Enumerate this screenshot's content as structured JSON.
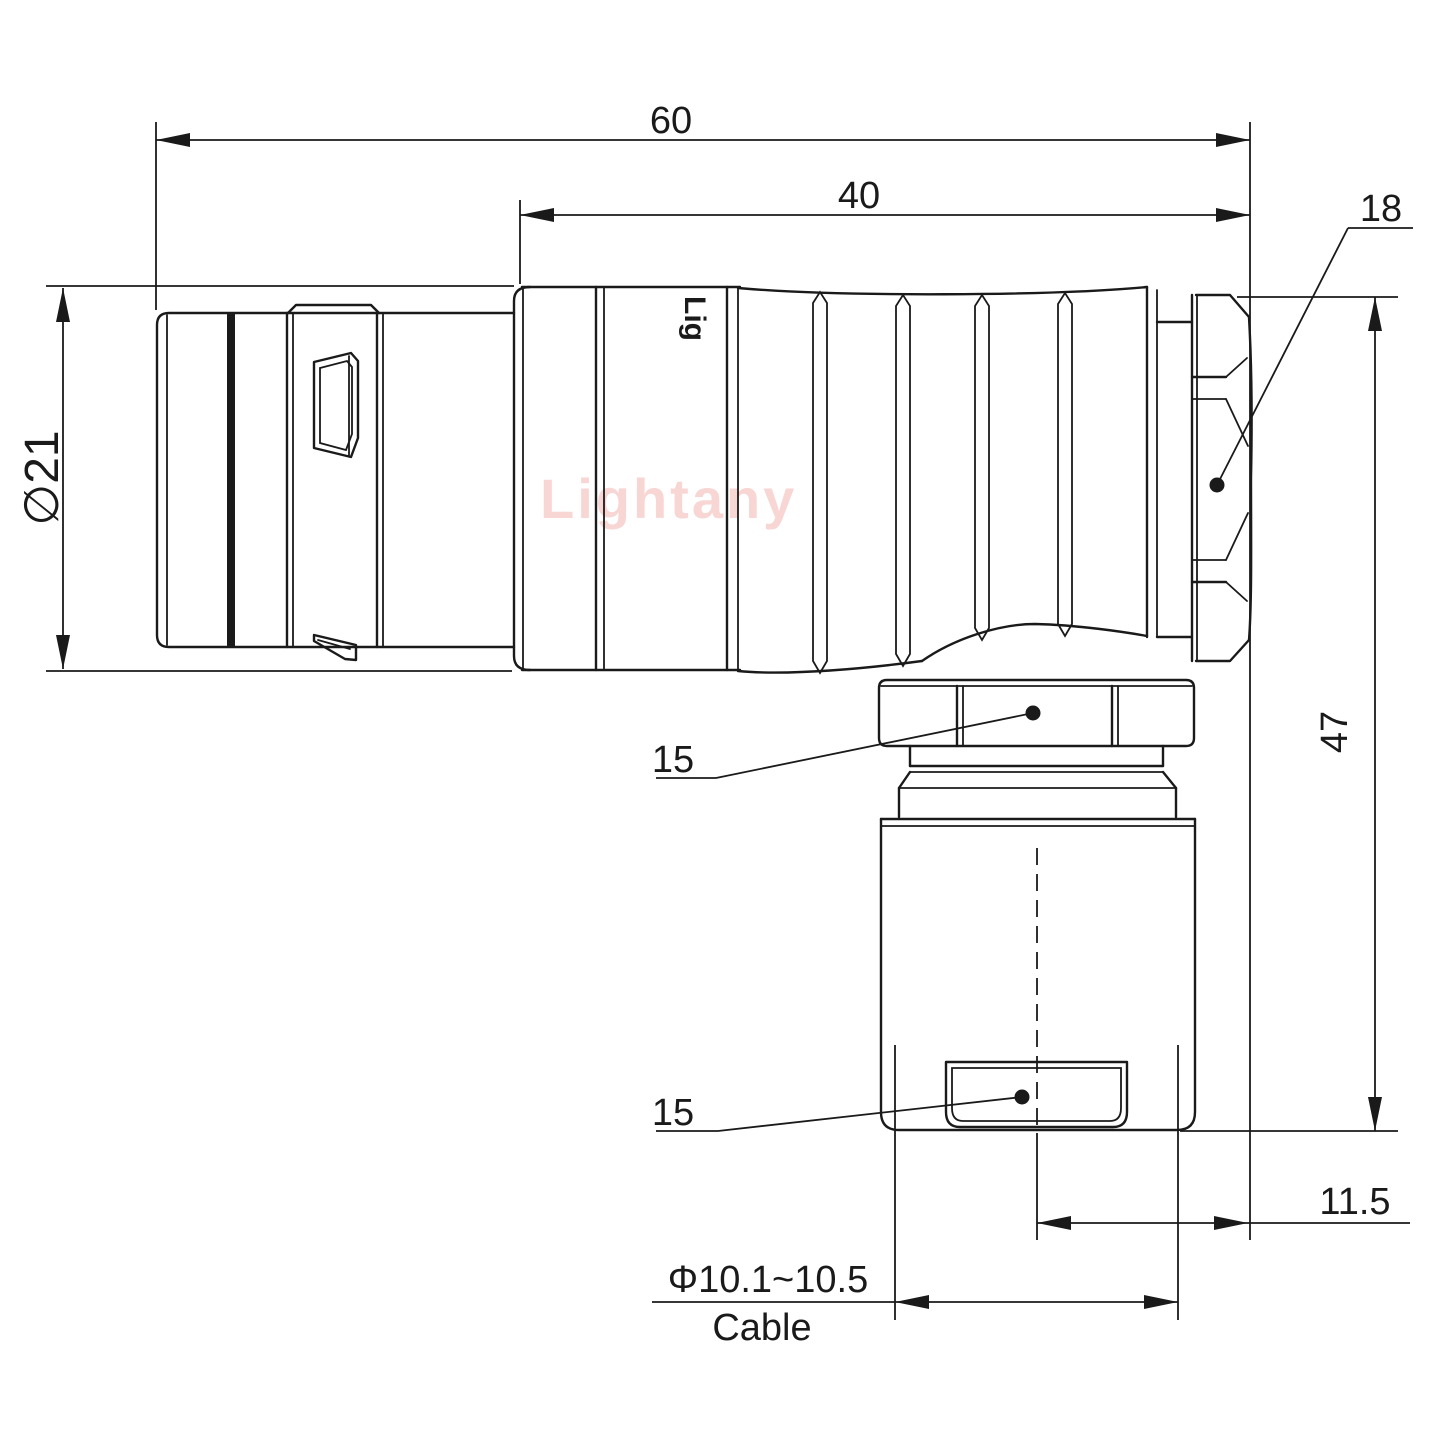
{
  "watermark": "Lightany",
  "brand_partial": "Lig",
  "dims": {
    "overall_length": "60",
    "rear_length": "40",
    "nut_size": "18",
    "shell_diameter": "∅21",
    "total_height": "47",
    "coupling_hex": "15",
    "clamp_hex": "15",
    "cable_offset": "11.5",
    "cable_diameter_range": "Φ10.1~10.5",
    "cable_word": "Cable"
  },
  "colors": {
    "line": "#1a1a1a",
    "watermark": "#f8d6d4",
    "background": "#ffffff"
  }
}
